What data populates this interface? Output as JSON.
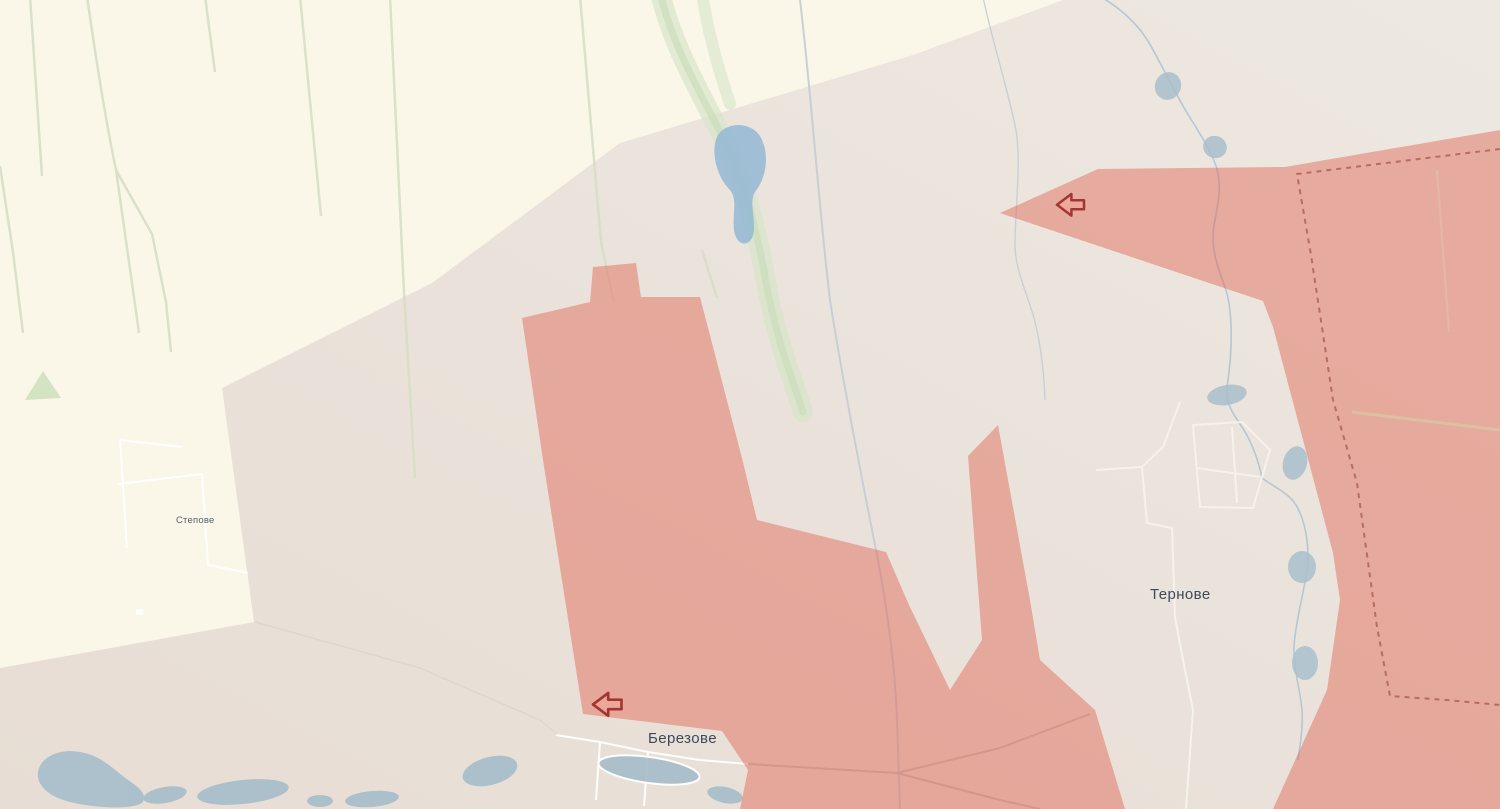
{
  "map": {
    "description": "Territorial control map fragment with contested gray zone, occupied pink zones and attack direction arrows",
    "place_labels": [
      {
        "id": "stepove",
        "name": "Степове"
      },
      {
        "id": "ternove",
        "name": "Тернове"
      },
      {
        "id": "berezove",
        "name": "Березове"
      }
    ],
    "markers": [
      {
        "icon": "attack-arrow-icon",
        "direction": "left",
        "area": "north-east sector"
      },
      {
        "icon": "attack-arrow-icon",
        "direction": "left",
        "area": "north of Berezove"
      }
    ],
    "colors": {
      "free-area": "#FAF7E8",
      "gray-zone-light": "#EDE8E1",
      "gray-zone-dark": "#E7DDD4",
      "occupied-fill": "rgba(225,97,80,0.45)",
      "frontline-dash": "#AE6355",
      "water": "#93B7D5",
      "lake": "#A9BFCB",
      "greenery": "#D6DDC4",
      "label-color": "#3D4A5C",
      "arrow-stroke": "#A33634"
    }
  }
}
